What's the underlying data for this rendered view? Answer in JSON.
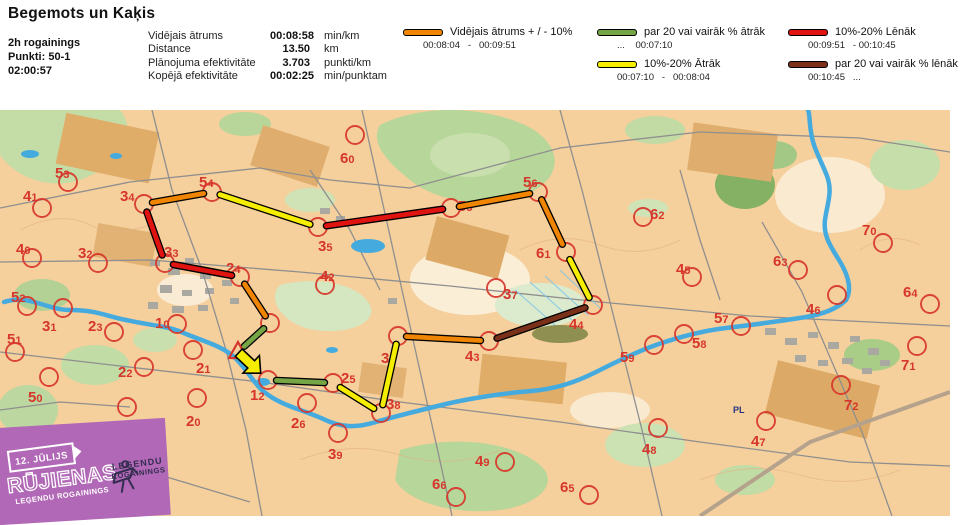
{
  "header": {
    "title": "Begemots un Kaķis",
    "event": "2h rogainings",
    "points": "Punkti: 50-1",
    "time": "02:00:57",
    "stats": [
      {
        "label": "Vidējais ātrums",
        "value": "00:08:58",
        "unit": "min/km"
      },
      {
        "label": "Distance",
        "value": "13.50",
        "unit": "km"
      },
      {
        "label": "Plānojuma efektivitāte",
        "value": "3.703",
        "unit": "punkti/km"
      },
      {
        "label": "Kopējā efektivitāte",
        "value": "00:02:25",
        "unit": "min/punktam"
      }
    ]
  },
  "legend": {
    "items": [
      {
        "key": "avg",
        "label": "Vidējais ātrums + / - 10%",
        "range": "00:08:04   -   00:09:51"
      },
      {
        "key": "fast20",
        "label": "par 20 vai vairāk % ātrāk",
        "range": "...    00:07:10"
      },
      {
        "key": "fast10",
        "label": "10%-20% Ātrāk",
        "range": "00:07:10   -   00:08:04"
      },
      {
        "key": "slow10",
        "label": "10%-20% Lēnāk",
        "range": "00:09:51   - 00:10:45"
      },
      {
        "key": "slow20",
        "label": "par 20 vai vairāk % lēnāk",
        "range": "00:10:45   ..."
      }
    ]
  },
  "banner": {
    "date": "12. JŪLIJS",
    "title": "RŪJIENAS",
    "subtitle": "LEĢENDU ROGAININGS",
    "logo_line1": "LEĢENDU",
    "logo_line2": "ROGAININGS"
  },
  "map": {
    "width": 950,
    "height": 406,
    "palette": {
      "avg": "#ef8500",
      "fast20": "#76a546",
      "fast10": "#f6ee00",
      "slow10": "#df1410",
      "slow20": "#7b3119",
      "control": "#d6362b"
    },
    "start": {
      "x": 238,
      "y": 242
    },
    "feature_label": {
      "text": "PL",
      "x": 733,
      "y": 303
    },
    "controls": [
      {
        "n": "10",
        "x": 177,
        "y": 214,
        "lx": 155,
        "ly": 218
      },
      {
        "n": "11",
        "x": 270,
        "y": 213,
        "hidden": true
      },
      {
        "n": "12",
        "x": 268,
        "y": 270,
        "lx": 250,
        "ly": 290
      },
      {
        "n": "20",
        "x": 197,
        "y": 288,
        "lx": 186,
        "ly": 316
      },
      {
        "n": "21",
        "x": 193,
        "y": 240,
        "lx": 196,
        "ly": 263
      },
      {
        "n": "22",
        "x": 144,
        "y": 257,
        "lx": 118,
        "ly": 267
      },
      {
        "n": "23",
        "x": 114,
        "y": 222,
        "lx": 88,
        "ly": 221
      },
      {
        "n": "24",
        "x": 240,
        "y": 167,
        "lx": 226,
        "ly": 163
      },
      {
        "n": "25",
        "x": 333,
        "y": 273,
        "lx": 341,
        "ly": 273
      },
      {
        "n": "26",
        "x": 307,
        "y": 293,
        "lx": 291,
        "ly": 318
      },
      {
        "n": "30",
        "x": 127,
        "y": 297,
        "lx": 104,
        "ly": 322
      },
      {
        "n": "31",
        "x": 63,
        "y": 198,
        "lx": 42,
        "ly": 221
      },
      {
        "n": "32",
        "x": 98,
        "y": 153,
        "lx": 78,
        "ly": 148
      },
      {
        "n": "33",
        "x": 165,
        "y": 153,
        "lx": 164,
        "ly": 147
      },
      {
        "n": "34",
        "x": 144,
        "y": 94,
        "lx": 120,
        "ly": 91
      },
      {
        "n": "35",
        "x": 318,
        "y": 117,
        "lx": 318,
        "ly": 141
      },
      {
        "n": "36",
        "x": 398,
        "y": 226,
        "lx": 381,
        "ly": 253
      },
      {
        "n": "37",
        "x": 496,
        "y": 178,
        "lx": 503,
        "ly": 189
      },
      {
        "n": "38",
        "x": 381,
        "y": 303,
        "lx": 386,
        "ly": 299
      },
      {
        "n": "39",
        "x": 338,
        "y": 323,
        "lx": 328,
        "ly": 349
      },
      {
        "n": "40",
        "x": 32,
        "y": 148,
        "lx": 16,
        "ly": 144
      },
      {
        "n": "41",
        "x": 42,
        "y": 98,
        "lx": 23,
        "ly": 91
      },
      {
        "n": "42",
        "x": 325,
        "y": 175,
        "lx": 320,
        "ly": 171
      },
      {
        "n": "43",
        "x": 489,
        "y": 231,
        "lx": 465,
        "ly": 251
      },
      {
        "n": "44",
        "x": 593,
        "y": 195,
        "lx": 569,
        "ly": 219
      },
      {
        "n": "45",
        "x": 692,
        "y": 167,
        "lx": 676,
        "ly": 164
      },
      {
        "n": "46",
        "x": 837,
        "y": 185,
        "lx": 806,
        "ly": 204
      },
      {
        "n": "47",
        "x": 766,
        "y": 311,
        "lx": 751,
        "ly": 336
      },
      {
        "n": "48",
        "x": 658,
        "y": 318,
        "lx": 642,
        "ly": 344
      },
      {
        "n": "49",
        "x": 505,
        "y": 352,
        "lx": 475,
        "ly": 356
      },
      {
        "n": "50",
        "x": 49,
        "y": 267,
        "lx": 28,
        "ly": 292
      },
      {
        "n": "51",
        "x": 15,
        "y": 242,
        "lx": 7,
        "ly": 234
      },
      {
        "n": "52",
        "x": 27,
        "y": 196,
        "lx": 11,
        "ly": 192
      },
      {
        "n": "53",
        "x": 68,
        "y": 72,
        "lx": 55,
        "ly": 68
      },
      {
        "n": "54",
        "x": 212,
        "y": 82,
        "lx": 199,
        "ly": 77
      },
      {
        "n": "55",
        "x": 451,
        "y": 98,
        "lx": 458,
        "ly": 101
      },
      {
        "n": "56",
        "x": 538,
        "y": 82,
        "lx": 523,
        "ly": 77
      },
      {
        "n": "57",
        "x": 741,
        "y": 216,
        "lx": 714,
        "ly": 213
      },
      {
        "n": "58",
        "x": 684,
        "y": 224,
        "lx": 692,
        "ly": 238
      },
      {
        "n": "59",
        "x": 654,
        "y": 235,
        "lx": 620,
        "ly": 252
      },
      {
        "n": "60",
        "x": 355,
        "y": 25,
        "lx": 340,
        "ly": 53
      },
      {
        "n": "61",
        "x": 566,
        "y": 142,
        "lx": 536,
        "ly": 148
      },
      {
        "n": "62",
        "x": 643,
        "y": 107,
        "lx": 650,
        "ly": 109
      },
      {
        "n": "63",
        "x": 798,
        "y": 160,
        "lx": 773,
        "ly": 156
      },
      {
        "n": "64",
        "x": 930,
        "y": 194,
        "lx": 903,
        "ly": 187
      },
      {
        "n": "65",
        "x": 589,
        "y": 385,
        "lx": 560,
        "ly": 382
      },
      {
        "n": "66",
        "x": 456,
        "y": 387,
        "lx": 432,
        "ly": 379
      },
      {
        "n": "70",
        "x": 883,
        "y": 133,
        "lx": 862,
        "ly": 125
      },
      {
        "n": "71",
        "x": 917,
        "y": 236,
        "lx": 901,
        "ly": 260
      },
      {
        "n": "72",
        "x": 841,
        "y": 275,
        "lx": 844,
        "ly": 300
      }
    ],
    "route": [
      {
        "from": "start",
        "to": "12",
        "key": "fast10",
        "arrow": true
      },
      {
        "from": "12",
        "to": "25",
        "key": "fast20"
      },
      {
        "from": "25",
        "to": "38",
        "key": "fast10"
      },
      {
        "from": "38",
        "to": "36",
        "key": "fast10"
      },
      {
        "from": "36",
        "to": "43",
        "key": "avg"
      },
      {
        "from": "43",
        "to": "44",
        "key": "slow20"
      },
      {
        "from": "44",
        "to": "61",
        "key": "fast10"
      },
      {
        "from": "61",
        "to": "56",
        "key": "avg"
      },
      {
        "from": "56",
        "to": "55",
        "key": "avg"
      },
      {
        "from": "55",
        "to": "35",
        "key": "slow10"
      },
      {
        "from": "35",
        "to": "54",
        "key": "fast10"
      },
      {
        "from": "54",
        "to": "34",
        "key": "avg"
      },
      {
        "from": "34",
        "to": "33",
        "key": "slow10"
      },
      {
        "from": "33",
        "to": "24",
        "key": "slow10"
      },
      {
        "from": "24",
        "to": "11",
        "key": "avg"
      },
      {
        "from": "11",
        "to": "start",
        "key": "fast20"
      }
    ]
  }
}
